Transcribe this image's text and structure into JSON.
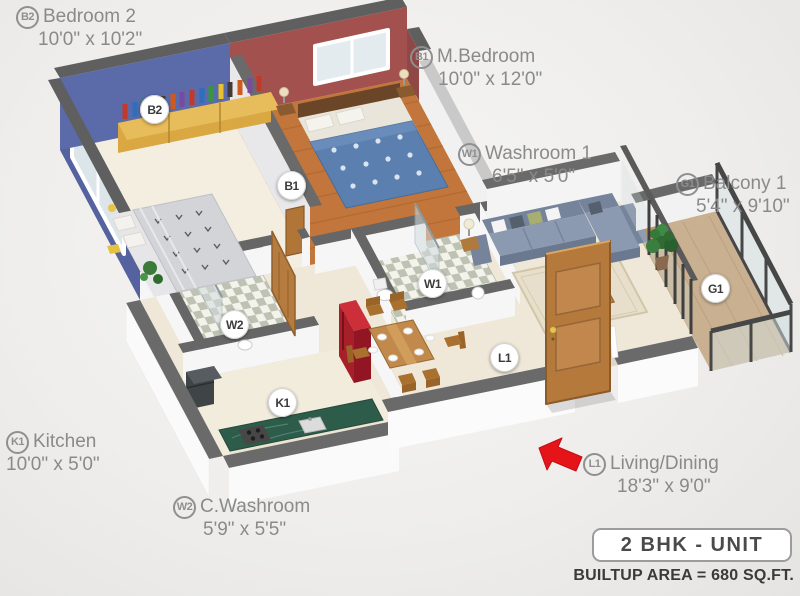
{
  "legend": {
    "unit_label": "2 BHK - UNIT",
    "builtup_label": "BUILTUP AREA = 680 SQ.FT."
  },
  "rooms": [
    {
      "code": "B2",
      "name": "Bedroom 2",
      "dims": "10'0\" x 10'2\""
    },
    {
      "code": "B1",
      "name": "M.Bedroom",
      "dims": "10'0\" x 12'0\""
    },
    {
      "code": "W1",
      "name": "Washroom 1",
      "dims": "6'5\" x 5'0\""
    },
    {
      "code": "G1",
      "name": "Balcony 1",
      "dims": "5'4\" x 9'10\""
    },
    {
      "code": "K1",
      "name": "Kitchen",
      "dims": "10'0\" x 5'0\""
    },
    {
      "code": "W2",
      "name": "C.Washroom",
      "dims": "5'9\" x 5'5\""
    },
    {
      "code": "L1",
      "name": "Living/Dining",
      "dims": "18'3\" x 9'0\""
    }
  ],
  "colors": {
    "label_text": "#8a8a8a",
    "wall_top_gray": "#606060",
    "bedroom2_wall_blue": "#5463a0",
    "master_wall_maroon": "#a3514e",
    "wood_floor": "#c2763b",
    "kitchen_counter_green": "#2d5c4b",
    "fridge_red": "#a81e29",
    "sofa_blue_gray": "#8c9ab1",
    "entrance_arrow_red": "#e41419"
  }
}
